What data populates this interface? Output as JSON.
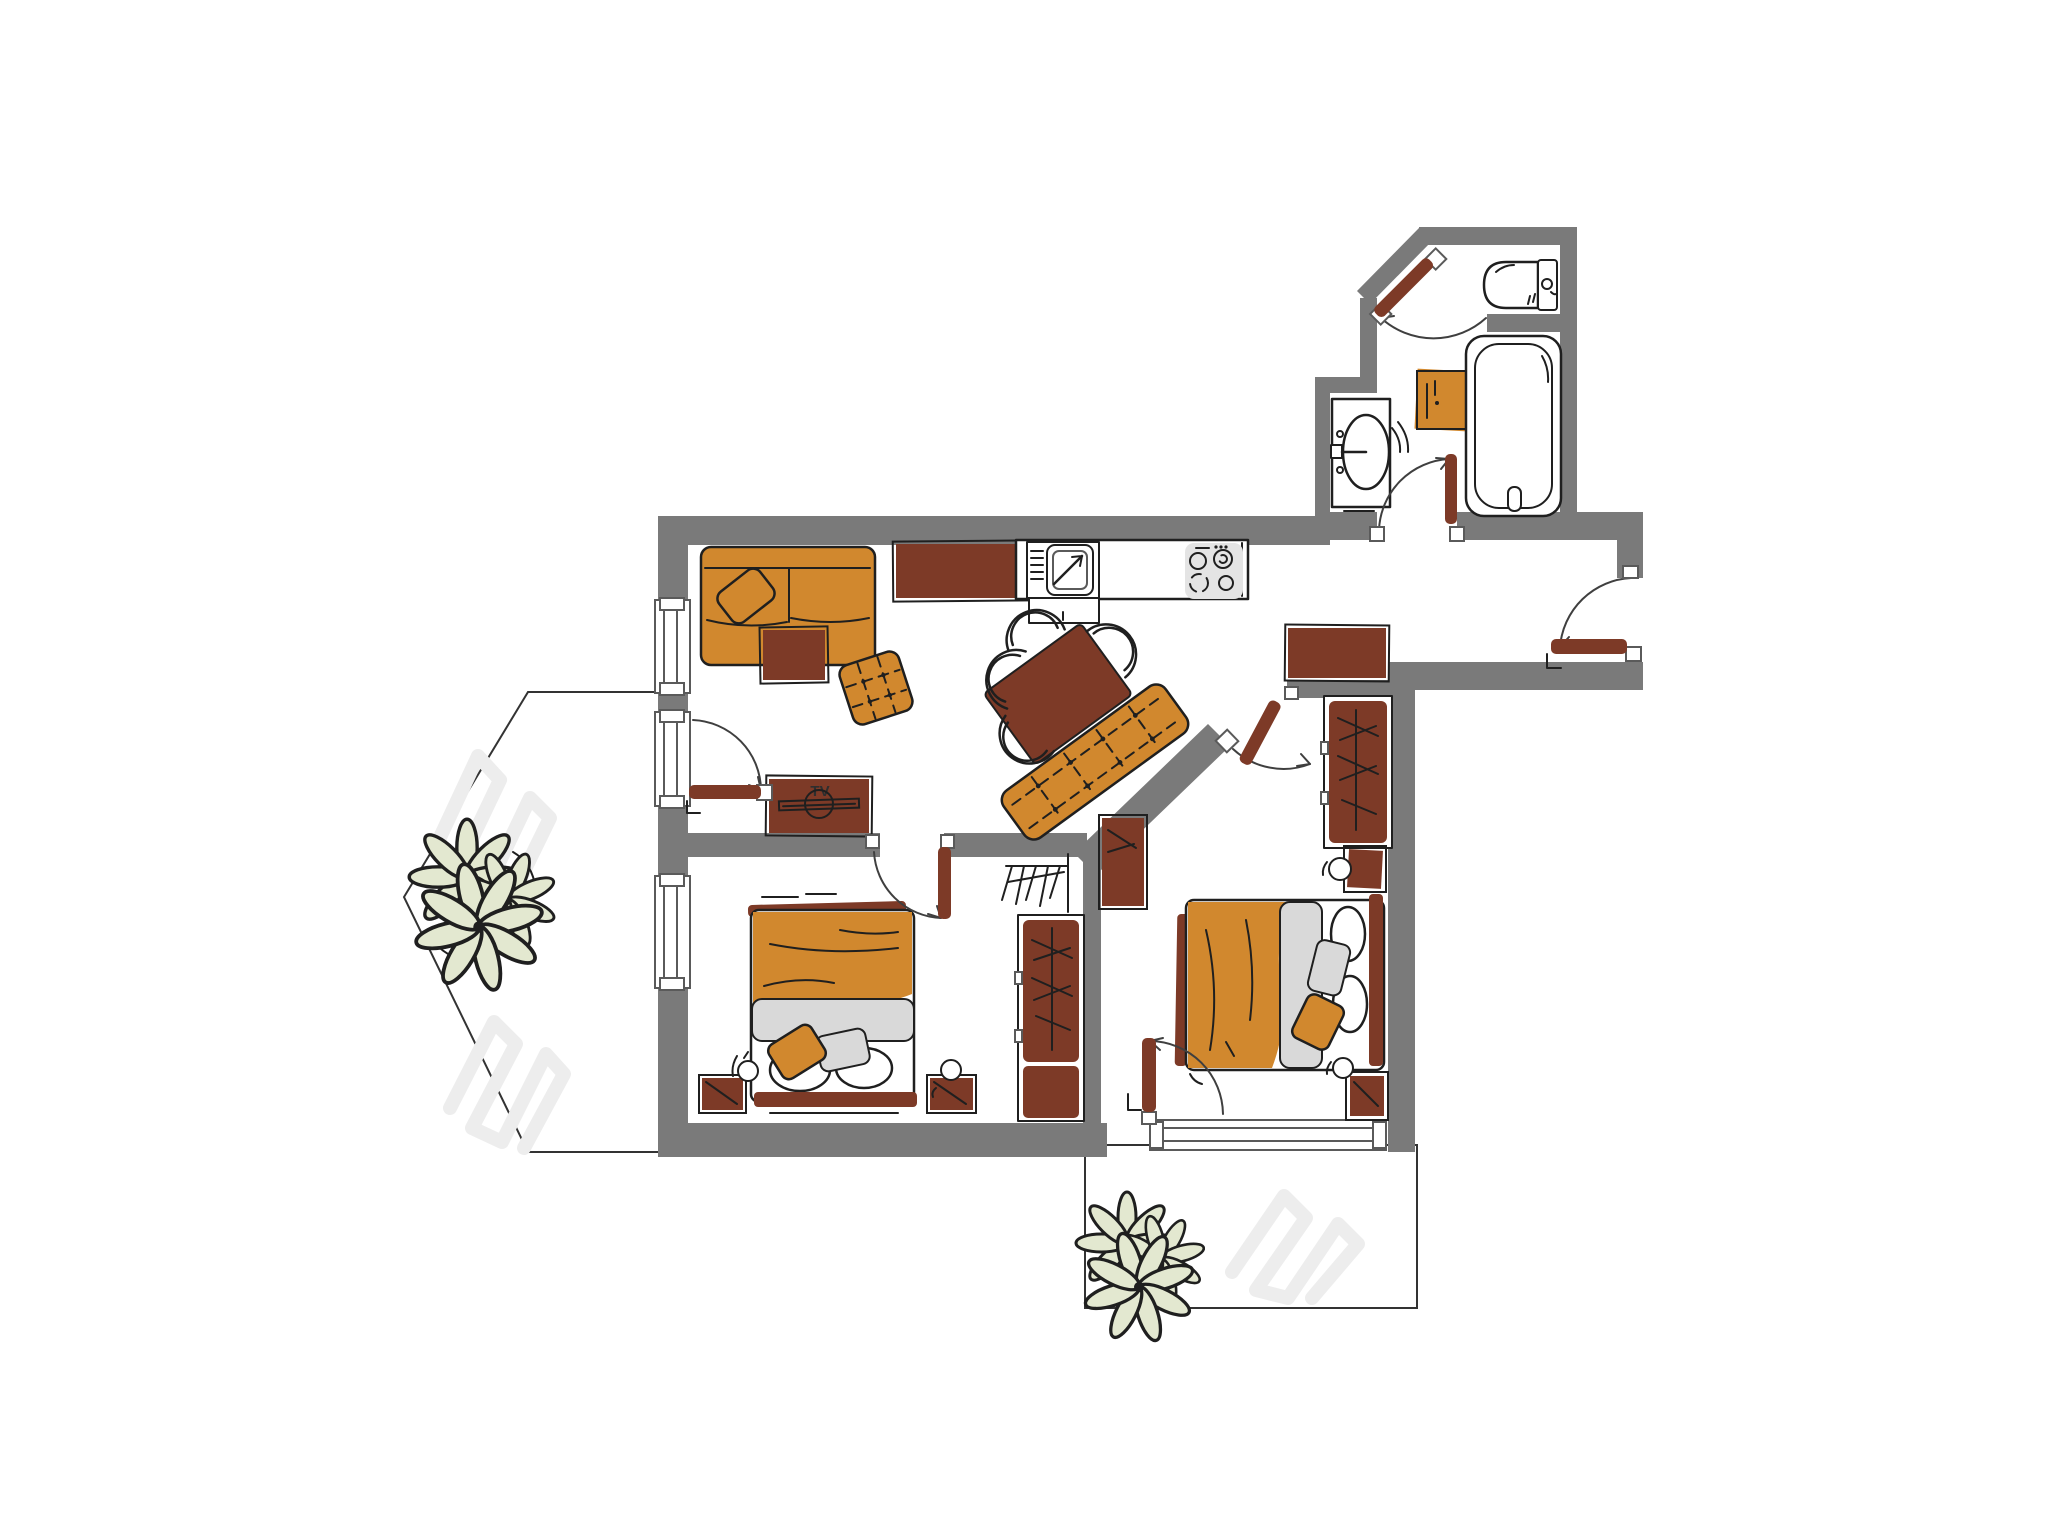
{
  "palette": {
    "wall": "#7a7a7a",
    "ink": "#1f1f1f",
    "arc": "#3f3f3f",
    "frame": "#5a5a5a",
    "orange": "#d1882e",
    "brown": "#7d3a27",
    "gray_soft": "#d9d9d9",
    "gray_tv": "#ececec",
    "plant": "#e3e8d0",
    "scribble": "#ededed",
    "paper": "#ffffff"
  },
  "labels": {
    "tv_label": "TV"
  },
  "plan": {
    "type": "apartment-floor-plan",
    "rooms": {
      "living_kitchen": [
        "corner-sofa",
        "throw-pillow",
        "coffee-table",
        "ottoman",
        "tv-stand",
        "sideboard",
        "kitchen-counter",
        "kitchen-sink",
        "stove",
        "dining-table",
        "dining-chairs",
        "tufted-bench",
        "balcony-door"
      ],
      "bedroom_left": [
        "double-bed",
        "blanket",
        "pillows",
        "nightstand-left",
        "nightstand-right",
        "table-lamps",
        "wardrobe",
        "clothes-rail",
        "window",
        "door"
      ],
      "bedroom_right": [
        "double-bed",
        "blanket",
        "pillows",
        "nightstand-top",
        "nightstand-bottom",
        "table-lamps",
        "wardrobe",
        "side-cabinet",
        "balcony-door-window",
        "door"
      ],
      "bathroom": [
        "washbasin",
        "washing-machine",
        "bathtub",
        "door"
      ],
      "wc": [
        "toilet",
        "door"
      ],
      "hallway": [
        "console",
        "entry-door"
      ],
      "balcony_left": [
        "plant",
        "sun-shading"
      ],
      "balcony_bottom": [
        "plant",
        "sun-shading"
      ]
    }
  }
}
